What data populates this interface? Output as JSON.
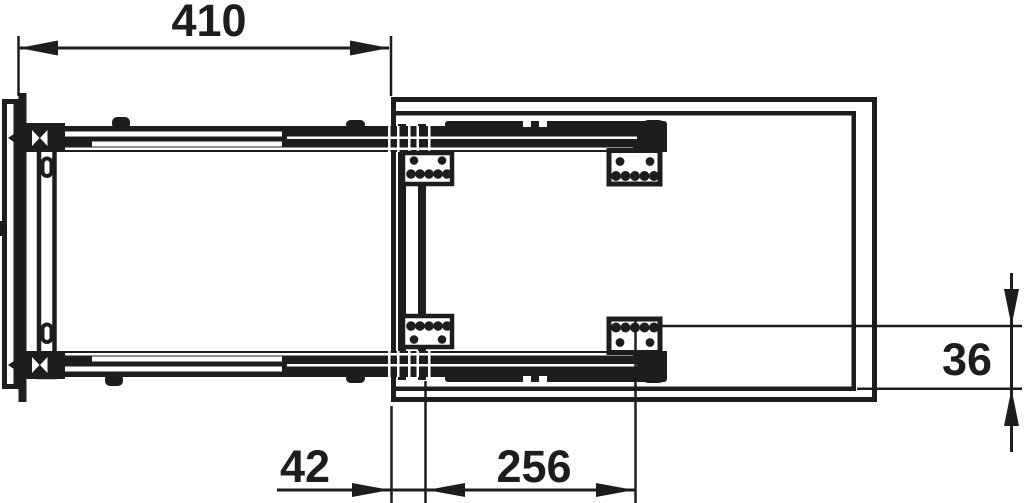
{
  "diagram": {
    "kind": "technical-drawing",
    "subject": "pull-out frame with telescopic runners and mounting brackets, top view",
    "ink_color": "#1d1d1b",
    "background_color": "#ffffff",
    "dimensions": {
      "extension_length": "410",
      "front_setback": "42",
      "bracket_pitch": "256",
      "side_inset": "36"
    }
  }
}
